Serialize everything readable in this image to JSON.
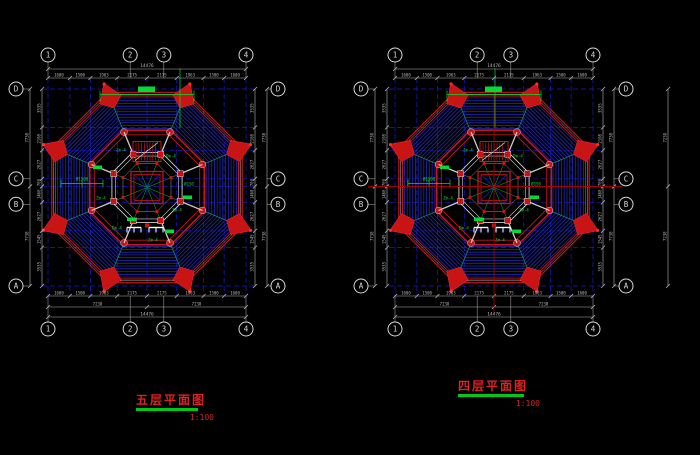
{
  "drawing_type": "cad-octagonal-pagoda-floor-plans",
  "background": "#000000",
  "colors": {
    "grid_line": "#1a1ad0",
    "roof_hatch": "#2228b4",
    "roof_red": "#c81414",
    "roof_bright": "#ff2a2a",
    "wall_gray": "#cfcfcf",
    "dim_gray": "#b4b4b4",
    "annotation_green": "#00dc32",
    "axis_red": "#a00000",
    "title_red": "#d82424",
    "title_underline_green": "#00c818",
    "bubble_white": "#d8d8d8"
  },
  "plans": [
    {
      "name": "fifth-floor-plan",
      "title": "五层平面图",
      "scale_label": "1:100",
      "column_bubbles": [
        "1",
        "2",
        "3",
        "4"
      ],
      "row_bubbles": [
        "D",
        "C",
        "B",
        "A"
      ],
      "dims_horizontal": {
        "overall": "14476",
        "halves": [
          "7238",
          "7238"
        ],
        "segments": [
          "1600",
          "1500",
          "1963",
          "2175",
          "2175",
          "1963",
          "1500",
          "1600"
        ]
      },
      "dims_vertical": {
        "halves": [
          "7738",
          "7738"
        ],
        "segments": [
          "3535",
          "2108",
          "2627",
          "700",
          "1460",
          "2627",
          "1545",
          "3535"
        ]
      },
      "annotations": [
        "Ø1500",
        "Zm-4",
        "Dm-4",
        "Ø150",
        "Zm-4",
        "Zm-4",
        "Dm-4",
        "Zm-4"
      ],
      "has_red_axis": false
    },
    {
      "name": "fourth-floor-plan",
      "title": "四层平面图",
      "scale_label": "1:100",
      "column_bubbles": [
        "1",
        "2",
        "3",
        "4"
      ],
      "row_bubbles": [
        "D",
        "C",
        "B",
        "A"
      ],
      "dims_horizontal": {
        "overall": "14476",
        "halves": [
          "7238",
          "7238"
        ],
        "segments": [
          "1600",
          "1500",
          "1963",
          "2175",
          "2175",
          "1963",
          "1500",
          "1600"
        ]
      },
      "dims_vertical": {
        "halves": [
          "7738",
          "7738"
        ],
        "segments": [
          "3535",
          "2108",
          "2627",
          "700",
          "1460",
          "2627",
          "1545",
          "3535"
        ]
      },
      "dims_far_right": [
        "7238",
        "7238"
      ],
      "annotations": [
        "Ø1500",
        "Zm-4",
        "Dm-4",
        "Ø150",
        "Zm-4",
        "Zm-4",
        "Dm-4",
        "Zm-4"
      ],
      "has_red_axis": true
    }
  ]
}
